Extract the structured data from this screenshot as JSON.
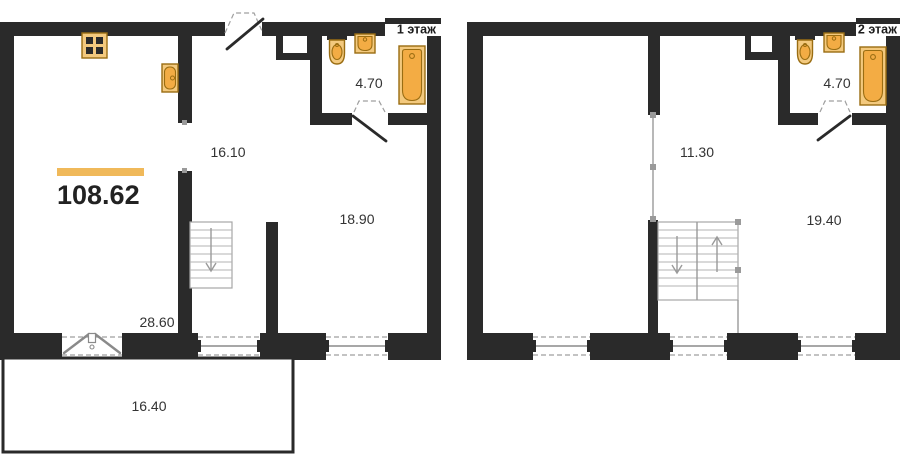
{
  "plan": {
    "total_area": "108.62",
    "floor1": {
      "label": "1 этаж",
      "rooms": {
        "kitchen_dining": {
          "area": "16.10"
        },
        "living_room": {
          "area": "18.90"
        },
        "bathroom": {
          "area": "4.70"
        },
        "hall": {
          "area": "28.60"
        },
        "terrace": {
          "area": "16.40"
        }
      }
    },
    "floor2": {
      "label": "2 этаж",
      "rooms": {
        "hall": {
          "area": "11.30"
        },
        "bedroom": {
          "area": "19.40"
        },
        "bathroom": {
          "area": "4.70"
        }
      }
    },
    "colors": {
      "wall": "#2a2a2a",
      "accent_bar": "#f0b95a",
      "fixture_fill": "#f3c97e",
      "fixture_inner": "#f3ac44",
      "fixture_outline": "#9a6d12",
      "background": "#ffffff",
      "label_text": "#333333"
    },
    "icons": {
      "stove": "stove-icon",
      "kitchen_sink": "kitchen-sink-icon",
      "toilet": "toilet-icon",
      "washbasin": "washbasin-icon",
      "bathtub": "bathtub-icon",
      "stairs_down": "stairs-down-icon",
      "stairs_up_down": "stairs-up-down-icon"
    }
  }
}
